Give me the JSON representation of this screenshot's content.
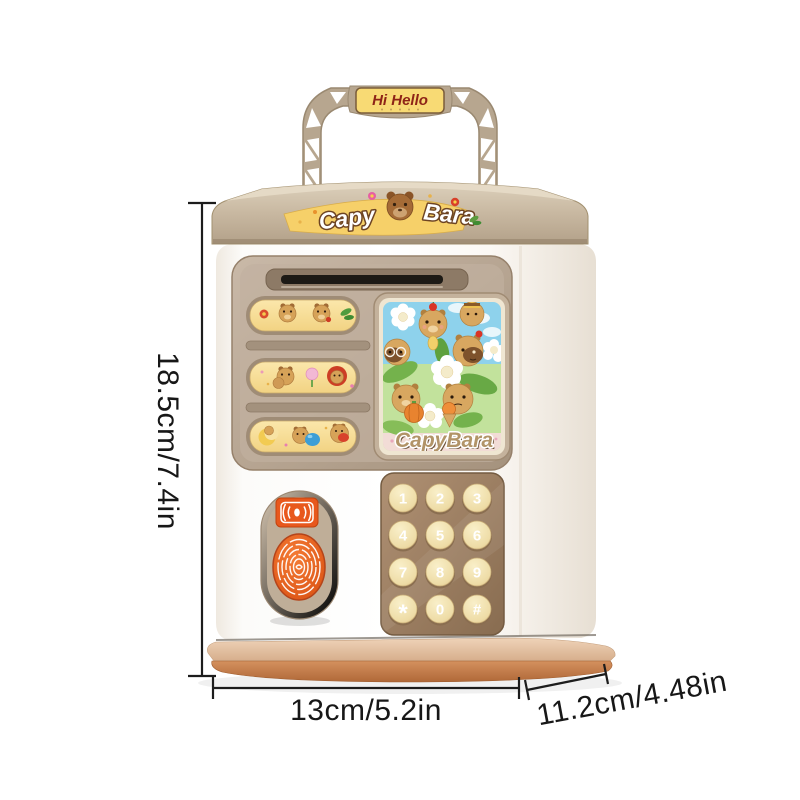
{
  "product": {
    "name": "capybara-atm-piggy-bank",
    "handle_badge_label": "Hi Hello",
    "lid_sticker": {
      "word_left": "Capy",
      "word_right": "Bara"
    },
    "screen_caption": "CapyBara",
    "keypad_keys": [
      "1",
      "2",
      "3",
      "4",
      "5",
      "6",
      "7",
      "8",
      "9",
      "*",
      "0",
      "#"
    ]
  },
  "dimensions": {
    "height_label": "18.5cm/7.4in",
    "width_label": "13cm/5.2in",
    "depth_label": "11.2cm/4.48in"
  },
  "colors": {
    "accent_orange": "#e8591d",
    "shell_white": "#fbfaf8",
    "trim_tan": "#b7a68f",
    "panel_tan": "#bcab99",
    "sticker_yellow": "#f6dc96",
    "keypad_brown": "#9c7f62",
    "key_cream": "#f0e0ae",
    "base_terracotta": "#c07a4e",
    "screen_sky_blue": "#8ed2ec",
    "badge_text_red": "#8e2417",
    "dimension_line_black": "#1c1c1c"
  }
}
